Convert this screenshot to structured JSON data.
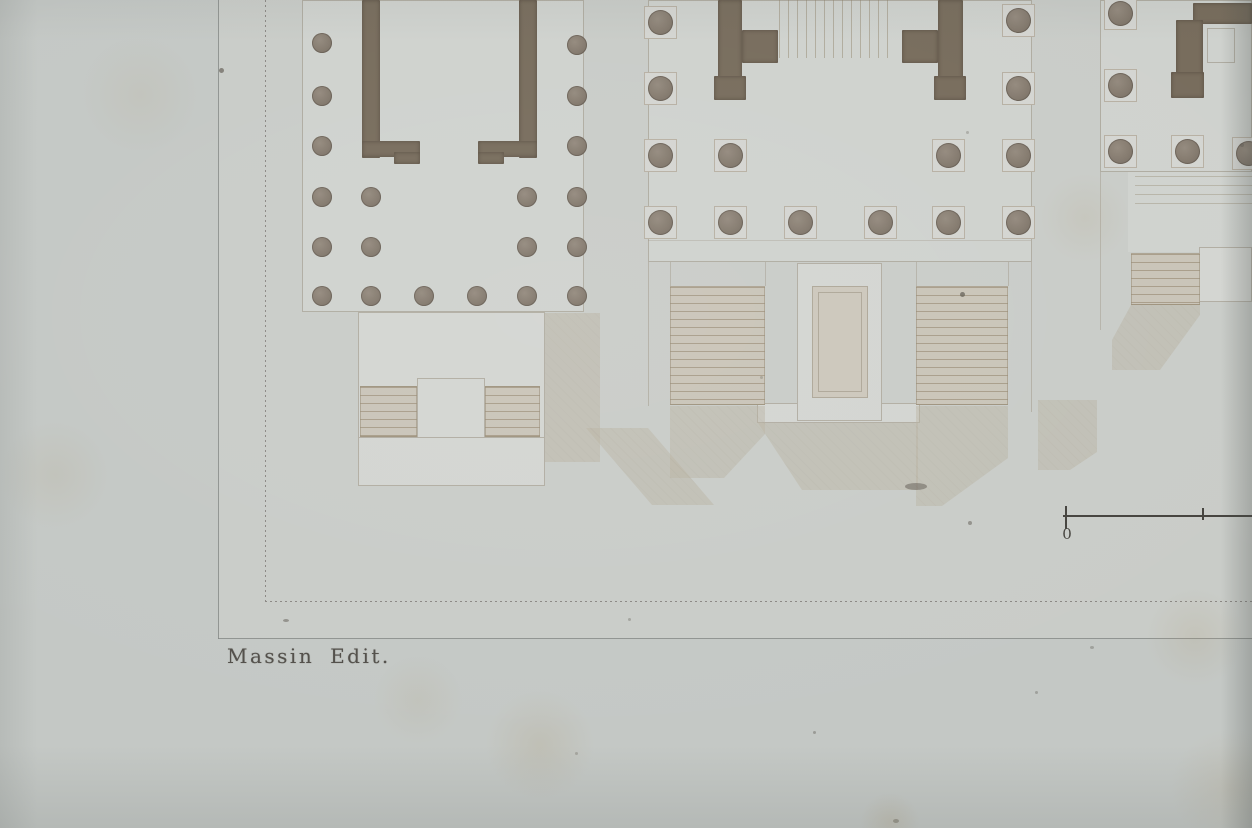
{
  "caption": {
    "text": "Massin Edit."
  },
  "scale_bar": {
    "zero_label": "0"
  },
  "colors": {
    "paper": "#c4c8c5",
    "ground": "#c9ccc8",
    "light1": "#cfd2ce",
    "light2": "#d3d5d1",
    "beige": "#ccc7bb",
    "paving": "#c6c2b6",
    "wall": "#776c5c",
    "plinthbg": "#d4d5d1",
    "plinthbd": "#b7b0a3",
    "stairbg": "#c9c4b8",
    "shadow": "#b9b1a0",
    "line": "#998f7d",
    "border": "#8b8884",
    "plate": "#828683",
    "ink": "#524f4a",
    "scale": "#45433e"
  },
  "plan": {
    "pavings": [
      {
        "x": 585,
        "y": 0,
        "w": 63,
        "h": 468
      },
      {
        "x": 1038,
        "y": 0,
        "w": 59,
        "h": 467
      }
    ],
    "platforms": [
      {
        "x": 218,
        "y": 0,
        "w": 1034,
        "h": 639,
        "bg": "ground"
      },
      {
        "x": 302,
        "y": 0,
        "w": 282,
        "h": 312,
        "bg": "light1",
        "border": true
      },
      {
        "x": 358,
        "y": 312,
        "w": 187,
        "h": 126,
        "bg": "light2",
        "border": true
      },
      {
        "x": 358,
        "y": 437,
        "w": 187,
        "h": 49,
        "bg": "light2",
        "border": true
      },
      {
        "x": 648,
        "y": 0,
        "w": 384,
        "h": 262,
        "bg": "light1",
        "border": true
      },
      {
        "x": 1100,
        "y": 0,
        "w": 152,
        "h": 172,
        "bg": "light1",
        "border": true
      },
      {
        "x": 1128,
        "y": 172,
        "w": 124,
        "h": 80,
        "bg": "light1"
      },
      {
        "x": 757,
        "y": 403,
        "w": 163,
        "h": 20,
        "bg": "light2",
        "border": true
      },
      {
        "x": 797,
        "y": 263,
        "w": 85,
        "h": 158,
        "bg": "light2",
        "border": true
      },
      {
        "x": 812,
        "y": 286,
        "w": 56,
        "h": 112,
        "bg": "beige",
        "border": true
      },
      {
        "x": 818,
        "y": 292,
        "w": 44,
        "h": 100,
        "bg": "none",
        "border": true
      },
      {
        "x": 1199,
        "y": 247,
        "w": 53,
        "h": 55,
        "bg": "light2",
        "border": true
      },
      {
        "x": 1207,
        "y": 28,
        "w": 28,
        "h": 35,
        "bg": "none",
        "border": true
      },
      {
        "x": 417,
        "y": 378,
        "w": 68,
        "h": 60,
        "bg": "light2",
        "border": true
      }
    ],
    "shadows": [
      {
        "clip": "polygon(545px 313px, 600px 313px, 600px 462px, 545px 462px)"
      },
      {
        "clip": "polygon(586px 428px, 648px 428px, 714px 505px, 652px 505px)"
      },
      {
        "clip": "polygon(670px 406px, 765px 406px, 765px 434px, 724px 478px, 670px 478px)"
      },
      {
        "clip": "polygon(758px 423px, 918px 423px, 918px 490px, 802px 490px)"
      },
      {
        "clip": "polygon(916px 406px, 1008px 406px, 1008px 458px, 942px 506px, 916px 506px)"
      },
      {
        "clip": "polygon(1131px 305px, 1200px 305px, 1200px 315px, 1160px 370px, 1112px 370px, 1112px 340px)"
      },
      {
        "clip": "polygon(1038px 400px, 1097px 400px, 1097px 452px, 1070px 470px, 1038px 470px)"
      }
    ],
    "stairs": [
      {
        "x": 779,
        "y": 0,
        "w": 111,
        "h": 58,
        "dir": "v"
      },
      {
        "x": 670,
        "y": 286,
        "w": 95,
        "h": 119,
        "dir": "h"
      },
      {
        "x": 916,
        "y": 286,
        "w": 92,
        "h": 119,
        "dir": "h"
      },
      {
        "x": 360,
        "y": 386,
        "w": 57,
        "h": 51,
        "dir": "h"
      },
      {
        "x": 485,
        "y": 386,
        "w": 55,
        "h": 51,
        "dir": "h"
      },
      {
        "x": 1131,
        "y": 253,
        "w": 69,
        "h": 52,
        "dir": "h"
      },
      {
        "x": 1135,
        "y": 176,
        "w": 117,
        "h": 36,
        "dir": "h2"
      }
    ],
    "lines": [
      {
        "x": 648,
        "y": 240,
        "w": 383,
        "h": 1,
        "a": 0.3
      },
      {
        "x": 648,
        "y": 262,
        "w": 1,
        "h": 144,
        "a": 0.45
      },
      {
        "x": 1031,
        "y": 262,
        "w": 1,
        "h": 150,
        "a": 0.45
      },
      {
        "x": 670,
        "y": 262,
        "w": 1,
        "h": 24,
        "a": 0.4
      },
      {
        "x": 765,
        "y": 262,
        "w": 1,
        "h": 24,
        "a": 0.4
      },
      {
        "x": 916,
        "y": 262,
        "w": 1,
        "h": 24,
        "a": 0.4
      },
      {
        "x": 1008,
        "y": 262,
        "w": 1,
        "h": 24,
        "a": 0.4
      },
      {
        "x": 1100,
        "y": 172,
        "w": 1,
        "h": 158,
        "a": 0.4
      }
    ],
    "walls": [
      {
        "x": 362,
        "y": 0,
        "w": 18,
        "h": 158
      },
      {
        "x": 362,
        "y": 141,
        "w": 58,
        "h": 16
      },
      {
        "x": 394,
        "y": 152,
        "w": 26,
        "h": 12
      },
      {
        "x": 519,
        "y": 0,
        "w": 18,
        "h": 158
      },
      {
        "x": 478,
        "y": 141,
        "w": 59,
        "h": 16
      },
      {
        "x": 478,
        "y": 152,
        "w": 26,
        "h": 12
      },
      {
        "x": 718,
        "y": 0,
        "w": 24,
        "h": 100
      },
      {
        "x": 742,
        "y": 30,
        "w": 36,
        "h": 33
      },
      {
        "x": 714,
        "y": 76,
        "w": 32,
        "h": 24
      },
      {
        "x": 938,
        "y": 0,
        "w": 25,
        "h": 100
      },
      {
        "x": 902,
        "y": 30,
        "w": 36,
        "h": 33
      },
      {
        "x": 934,
        "y": 76,
        "w": 32,
        "h": 24
      },
      {
        "x": 1193,
        "y": 3,
        "w": 59,
        "h": 21
      },
      {
        "x": 1176,
        "y": 20,
        "w": 27,
        "h": 58
      },
      {
        "x": 1171,
        "y": 72,
        "w": 33,
        "h": 26
      }
    ],
    "columns": [
      {
        "x": 322,
        "y": 43,
        "d": 20
      },
      {
        "x": 322,
        "y": 96,
        "d": 20
      },
      {
        "x": 322,
        "y": 146,
        "d": 20
      },
      {
        "x": 322,
        "y": 197,
        "d": 20
      },
      {
        "x": 322,
        "y": 247,
        "d": 20
      },
      {
        "x": 322,
        "y": 296,
        "d": 20
      },
      {
        "x": 577,
        "y": 45,
        "d": 20
      },
      {
        "x": 577,
        "y": 96,
        "d": 20
      },
      {
        "x": 577,
        "y": 146,
        "d": 20
      },
      {
        "x": 577,
        "y": 197,
        "d": 20
      },
      {
        "x": 577,
        "y": 247,
        "d": 20
      },
      {
        "x": 577,
        "y": 296,
        "d": 20
      },
      {
        "x": 371,
        "y": 197,
        "d": 20
      },
      {
        "x": 371,
        "y": 247,
        "d": 20
      },
      {
        "x": 371,
        "y": 296,
        "d": 20
      },
      {
        "x": 527,
        "y": 197,
        "d": 20
      },
      {
        "x": 527,
        "y": 247,
        "d": 20
      },
      {
        "x": 527,
        "y": 296,
        "d": 20
      },
      {
        "x": 424,
        "y": 296,
        "d": 20
      },
      {
        "x": 477,
        "y": 296,
        "d": 20
      },
      {
        "x": 660,
        "y": 22,
        "d": 25,
        "p": 33
      },
      {
        "x": 660,
        "y": 88,
        "d": 25,
        "p": 33
      },
      {
        "x": 660,
        "y": 155,
        "d": 25,
        "p": 33
      },
      {
        "x": 660,
        "y": 222,
        "d": 25,
        "p": 33
      },
      {
        "x": 1018,
        "y": 20,
        "d": 25,
        "p": 33
      },
      {
        "x": 1018,
        "y": 88,
        "d": 25,
        "p": 33
      },
      {
        "x": 1018,
        "y": 155,
        "d": 25,
        "p": 33
      },
      {
        "x": 1018,
        "y": 222,
        "d": 25,
        "p": 33
      },
      {
        "x": 730,
        "y": 155,
        "d": 25,
        "p": 33
      },
      {
        "x": 730,
        "y": 222,
        "d": 25,
        "p": 33
      },
      {
        "x": 948,
        "y": 155,
        "d": 25,
        "p": 33
      },
      {
        "x": 948,
        "y": 222,
        "d": 25,
        "p": 33
      },
      {
        "x": 800,
        "y": 222,
        "d": 25,
        "p": 33
      },
      {
        "x": 880,
        "y": 222,
        "d": 25,
        "p": 33
      },
      {
        "x": 1120,
        "y": 13,
        "d": 25,
        "p": 33
      },
      {
        "x": 1120,
        "y": 85,
        "d": 25,
        "p": 33
      },
      {
        "x": 1120,
        "y": 151,
        "d": 25,
        "p": 33
      },
      {
        "x": 1187,
        "y": 151,
        "d": 25,
        "p": 33
      },
      {
        "x": 1248,
        "y": 153,
        "d": 25,
        "p": 33
      }
    ]
  },
  "artifacts": {
    "specks": [
      {
        "x": 219,
        "y": 68,
        "w": 5,
        "h": 5,
        "o": 0.65
      },
      {
        "x": 960,
        "y": 292,
        "w": 5,
        "h": 5,
        "o": 0.7
      },
      {
        "x": 283,
        "y": 619,
        "w": 6,
        "h": 3,
        "o": 0.5
      },
      {
        "x": 905,
        "y": 483,
        "w": 22,
        "h": 7,
        "o": 0.5
      },
      {
        "x": 968,
        "y": 521,
        "w": 4,
        "h": 4,
        "o": 0.5
      },
      {
        "x": 1240,
        "y": 143,
        "w": 4,
        "h": 4,
        "o": 0.4
      },
      {
        "x": 813,
        "y": 731,
        "w": 3,
        "h": 3,
        "o": 0.4
      },
      {
        "x": 893,
        "y": 819,
        "w": 6,
        "h": 4,
        "o": 0.45
      },
      {
        "x": 628,
        "y": 618,
        "w": 3,
        "h": 3,
        "o": 0.35
      },
      {
        "x": 1035,
        "y": 691,
        "w": 3,
        "h": 3,
        "o": 0.35
      },
      {
        "x": 575,
        "y": 752,
        "w": 3,
        "h": 3,
        "o": 0.3
      },
      {
        "x": 1090,
        "y": 646,
        "w": 4,
        "h": 3,
        "o": 0.35
      },
      {
        "x": 966,
        "y": 131,
        "w": 3,
        "h": 3,
        "o": 0.3
      },
      {
        "x": 760,
        "y": 376,
        "w": 3,
        "h": 3,
        "o": 0.3
      }
    ],
    "stains": [
      {
        "x": 540,
        "y": 745,
        "r": 55,
        "o": 0.45
      },
      {
        "x": 1195,
        "y": 637,
        "r": 50,
        "o": 0.4
      },
      {
        "x": 1085,
        "y": 218,
        "r": 45,
        "o": 0.3
      },
      {
        "x": 418,
        "y": 700,
        "r": 45,
        "o": 0.28
      },
      {
        "x": 55,
        "y": 475,
        "r": 55,
        "o": 0.3
      },
      {
        "x": 1230,
        "y": 788,
        "r": 60,
        "o": 0.4
      },
      {
        "x": 140,
        "y": 95,
        "r": 60,
        "o": 0.25
      },
      {
        "x": 890,
        "y": 822,
        "r": 30,
        "o": 0.5
      }
    ]
  }
}
